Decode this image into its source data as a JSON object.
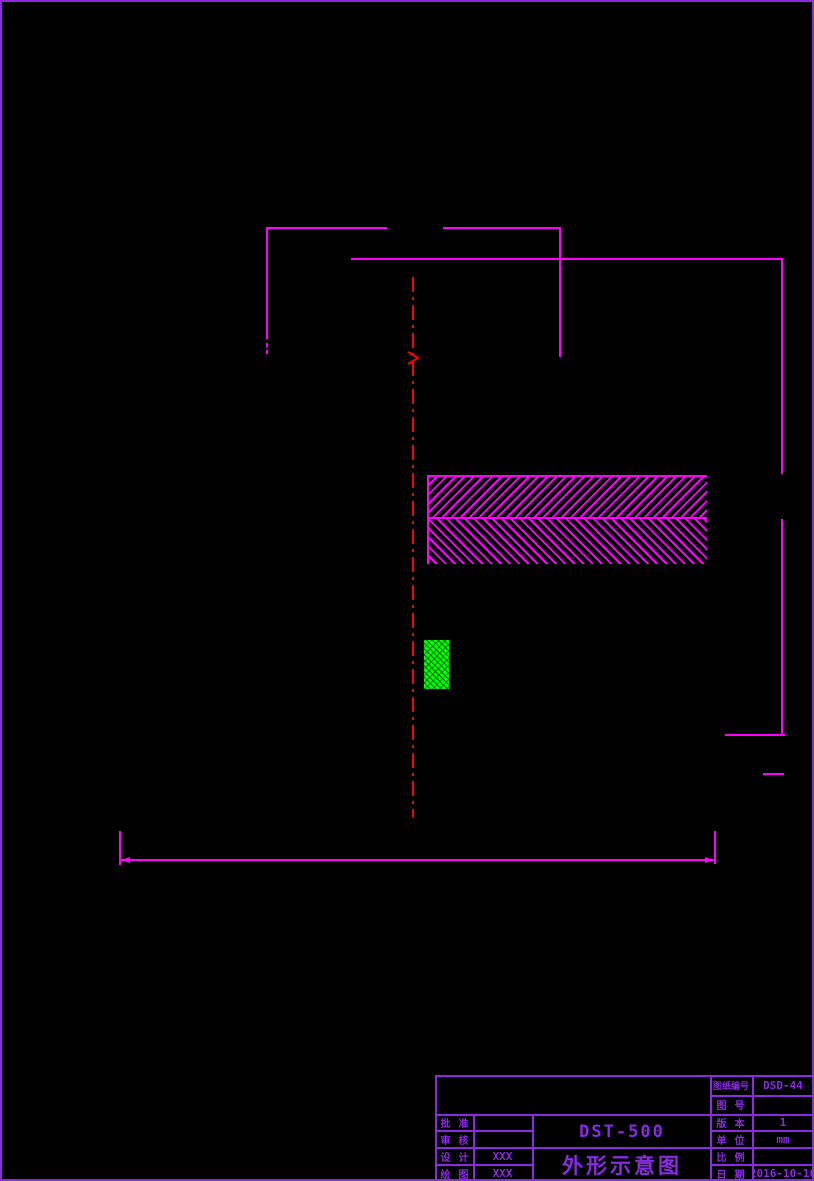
{
  "colors": {
    "page_border": "#8A2BE2",
    "title_block": "#8A2BE2",
    "dimension_line": "#FF00FF",
    "center_line": "#FF0000",
    "fill_green": "#00FF00"
  },
  "title_block": {
    "model": "DST-500",
    "drawing_title": "外形示意图",
    "fields": {
      "drawing_no": {
        "label": "图纸编号",
        "value": "DSD-44"
      },
      "figure_no": {
        "label": "图 号",
        "value": ""
      },
      "approved": {
        "label": "批 准",
        "value": ""
      },
      "reviewed": {
        "label": "审 核",
        "value": ""
      },
      "designed": {
        "label": "设 计",
        "value": "XXX"
      },
      "drafted": {
        "label": "绘 图",
        "value": "XXX"
      },
      "version": {
        "label": "版 本",
        "value": "1"
      },
      "unit": {
        "label": "单 位",
        "value": "mm"
      },
      "scale": {
        "label": "比 例",
        "value": ""
      },
      "date": {
        "label": "日 期",
        "value": "2016-10-10"
      }
    }
  }
}
